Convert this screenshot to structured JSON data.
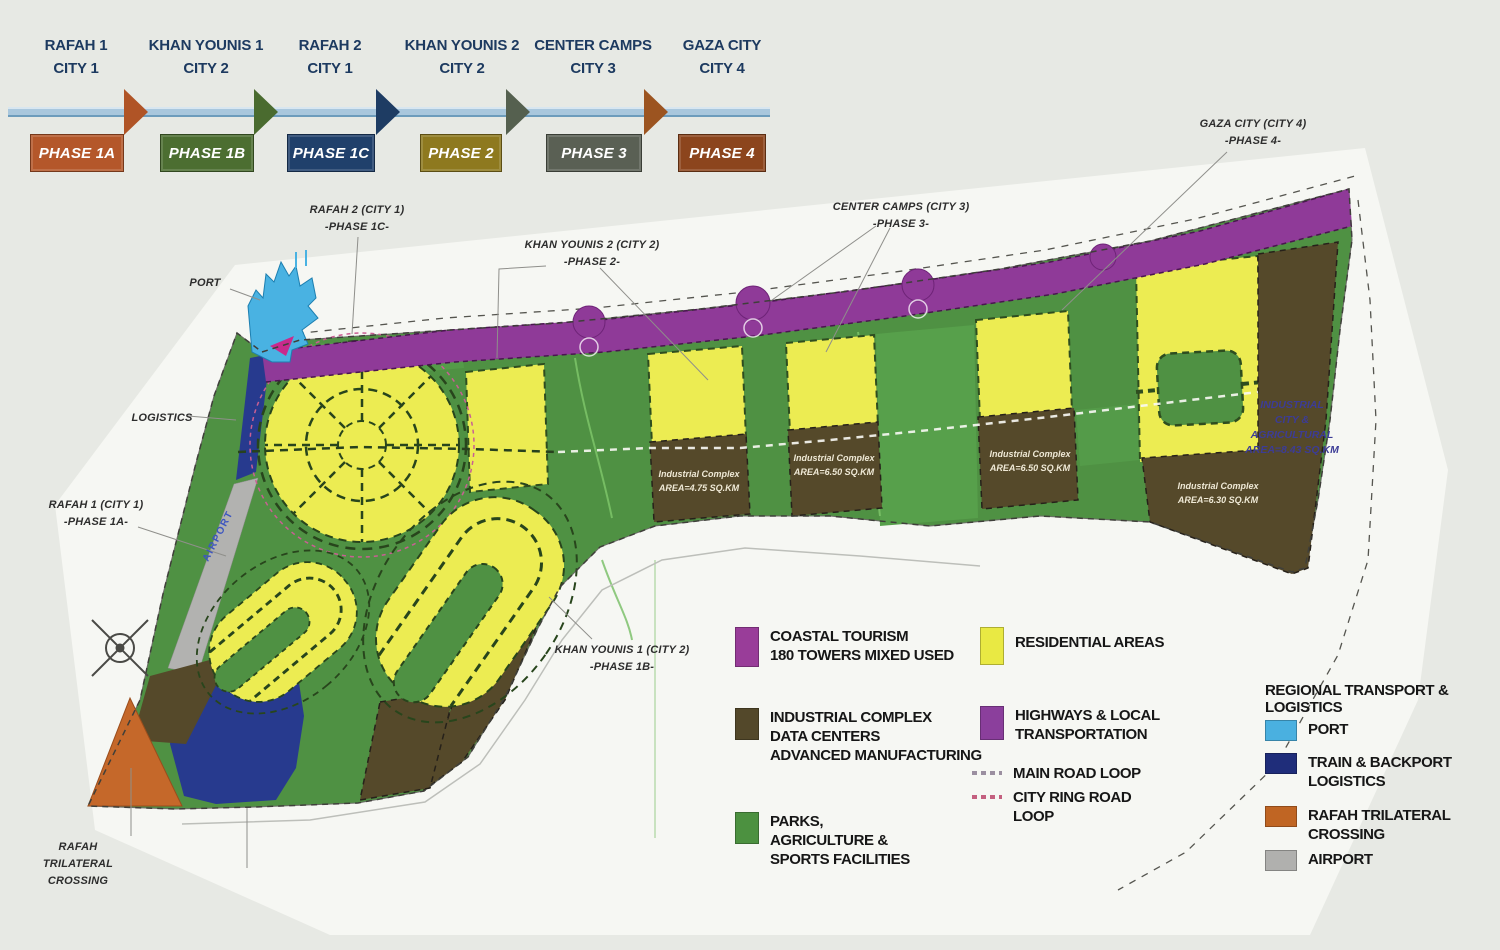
{
  "timeline": {
    "stages": [
      {
        "city": "RAFAH 1",
        "city2": "CITY 1",
        "phase": "PHASE 1A"
      },
      {
        "city": "KHAN YOUNIS 1",
        "city2": "CITY 2",
        "phase": "PHASE 1B"
      },
      {
        "city": "RAFAH 2",
        "city2": "CITY 1",
        "phase": "PHASE 1C"
      },
      {
        "city": "KHAN YOUNIS 2",
        "city2": "CITY 2",
        "phase": "PHASE 2"
      },
      {
        "city": "CENTER CAMPS",
        "city2": "CITY 3",
        "phase": "PHASE 3"
      },
      {
        "city": "GAZA CITY",
        "city2": "CITY 4",
        "phase": "PHASE 4"
      }
    ]
  },
  "map_labels": {
    "port": "PORT",
    "logistics": "LOGISTICS",
    "airport": "AIRPORT",
    "rafah1": {
      "l1": "RAFAH 1 (CITY 1)",
      "l2": "-PHASE 1A-"
    },
    "rafah2": {
      "l1": "RAFAH 2 (CITY 1)",
      "l2": "-PHASE 1C-"
    },
    "khanyounis1": {
      "l1": "KHAN YOUNIS 1 (CITY 2)",
      "l2": "-PHASE 1B-"
    },
    "khanyounis2": {
      "l1": "KHAN YOUNIS 2 (CITY 2)",
      "l2": "-PHASE 2-"
    },
    "centercamps": {
      "l1": "CENTER CAMPS (CITY 3)",
      "l2": "-PHASE 3-"
    },
    "gazacity": {
      "l1": "GAZA CITY (CITY 4)",
      "l2": "-PHASE 4-"
    },
    "crossing": {
      "l1": "RAFAH",
      "l2": "TRILATERAL",
      "l3": "CROSSING"
    }
  },
  "industrial_zones": [
    {
      "l1": "Industrial Complex",
      "l2": "AREA=4.75 SQ.KM"
    },
    {
      "l1": "Industrial Complex",
      "l2": "AREA=6.50 SQ.KM"
    },
    {
      "l1": "Industrial Complex",
      "l2": "AREA=6.50 SQ.KM"
    },
    {
      "l1": "Industrial Complex",
      "l2": "AREA=6.30 SQ.KM"
    }
  ],
  "right_zone": {
    "l1": "INDUSTRIAL",
    "l2": "CITY &",
    "l3": "AGRICULTURAL",
    "l4": "AREA=8.43 SQ.KM"
  },
  "legend_landuse": {
    "coastal": {
      "l1": "COASTAL TOURISM",
      "l2": "180 TOWERS MIXED USED"
    },
    "residential": "RESIDENTIAL AREAS",
    "industrial": {
      "l1": "INDUSTRIAL COMPLEX",
      "l2": "DATA CENTERS",
      "l3": "ADVANCED MANUFACTURING"
    },
    "highways": {
      "l1": "HIGHWAYS & LOCAL",
      "l2": "TRANSPORTATION"
    },
    "main_road": "MAIN ROAD LOOP",
    "ring_road": {
      "l1": "CITY RING ROAD",
      "l2": "LOOP"
    },
    "parks": {
      "l1": "PARKS,",
      "l2": "AGRICULTURE &",
      "l3": "SPORTS FACILITIES"
    }
  },
  "legend_transport": {
    "title": "REGIONAL TRANSPORT & LOGISTICS",
    "port": "PORT",
    "train": {
      "l1": "TRAIN & BACKPORT",
      "l2": "LOGISTICS"
    },
    "rafah": {
      "l1": "RAFAH TRILATERAL",
      "l2": "CROSSING"
    },
    "airport": "AIRPORT"
  },
  "colors": {
    "phases": [
      "#b4572a",
      "#4c6e31",
      "#20406b",
      "#8e791f",
      "#5a6054",
      "#8c451d"
    ],
    "arrows": [
      "#b05426",
      "#4a6b2f",
      "#1e3c63",
      "#55604f",
      "#9c5420"
    ],
    "coastal": "#993d99",
    "residential": "#e9e943",
    "industrial": "#53482a",
    "parks": "#4c9140",
    "highways": "#8b3f9c",
    "port": "#4ab0e0",
    "train": "#1f2d7a",
    "crossing": "#c06523",
    "airport": "#b0b0ae",
    "main_road": "#9b8fa0",
    "ring_road": "#c4607f"
  }
}
